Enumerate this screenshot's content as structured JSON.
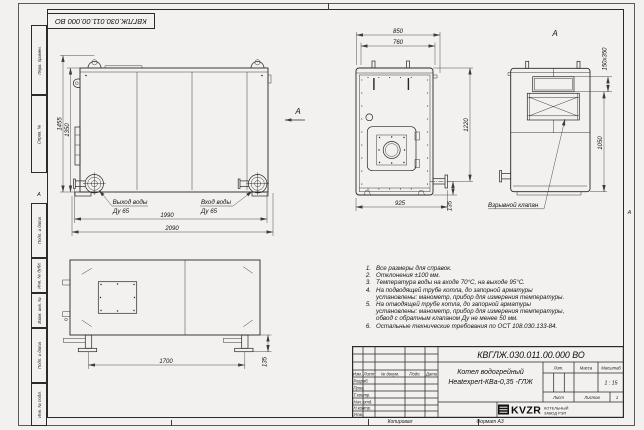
{
  "stamp_top": {
    "doc_number": "КВГЛЖ.030.011.00.000 ВО"
  },
  "margin": {
    "col_perv_primen": "Перв. примен.",
    "col_sprav_no": "Справ. №",
    "col_podp_data_1": "Подп. и дата",
    "col_inv_dubl": "Инв. № дубл.",
    "col_vzam_inv": "Взам. инв. №",
    "col_podp_data_2": "Подп. и дата",
    "col_inv_podl": "Инв. № подл.",
    "zone_left": "А",
    "zone_right": "А"
  },
  "views": {
    "side": {
      "dim_height_outer": "1455",
      "dim_height_inner": "1350",
      "dim_width_inner": "1990",
      "dim_width_outer": "2090",
      "outlet_label": "Выход воды",
      "outlet_dn": "Ду 65",
      "inlet_label": "Вход воды",
      "inlet_dn": "Ду 65",
      "view_arrow_label": "А"
    },
    "front": {
      "dim_top_outer": "850",
      "dim_top_inner": "760",
      "dim_height": "1220",
      "dim_bottom": "925",
      "dim_foot": "135"
    },
    "rear": {
      "view_label": "А",
      "dim_flue": "150х350",
      "dim_height": "1050",
      "explosion_valve_label": "Взрывной клапан"
    },
    "top": {
      "dim_feet_span": "1700",
      "dim_foot_height": "135"
    }
  },
  "notes": [
    {
      "num": "1.",
      "text": "Все размеры для справок."
    },
    {
      "num": "2.",
      "text": "Отклонения ±100 мм."
    },
    {
      "num": "3.",
      "text": "Температура воды на входе 70°С, на выходе 95°С."
    },
    {
      "num": "4.",
      "text": "На подводящей трубе котла, до запорной арматуры установлены: манометр, прибор для измерения температуры."
    },
    {
      "num": "5.",
      "text": "На отводящей трубе котла, до запорной арматуры установлены: манометр, прибор для измерения температуры, обвод с обратным клапаном Ду не менее 50 мм."
    },
    {
      "num": "6.",
      "text": "Остальные технические требования по ОСТ 108.030.133-84."
    }
  ],
  "title_block": {
    "doc_number": "КВГЛЖ.030.011.00.000 ВО",
    "product_name_line1": "Котел водогрейный",
    "product_name_line2": "Heatexpert-КВа-0,35 -ГЛЖ",
    "header_izm": "Изм.",
    "header_list": "Лист",
    "header_docum": "№ докум.",
    "header_podp": "Подп.",
    "header_data": "Дата",
    "row_razrab": "Разраб.",
    "row_prov": "Пров.",
    "row_tkontr": "Т.контр.",
    "row_nachotd": "Нач. отд.",
    "row_nkontr": "Н.контр.",
    "row_utv": "Утв.",
    "lit_label": "Лит.",
    "mass_label": "Масса",
    "scale_label": "Масштаб",
    "scale_value": "1 : 15",
    "sheet_label": "Лист",
    "sheets_label": "Листов",
    "sheets_value": "1",
    "company_logo": "KVZR",
    "company_line1": "КОТЕЛЬНЫЙ",
    "company_line2": "ЗАВОД РЭП"
  },
  "footer": {
    "copied": "Копировал",
    "format": "Формат А3"
  }
}
